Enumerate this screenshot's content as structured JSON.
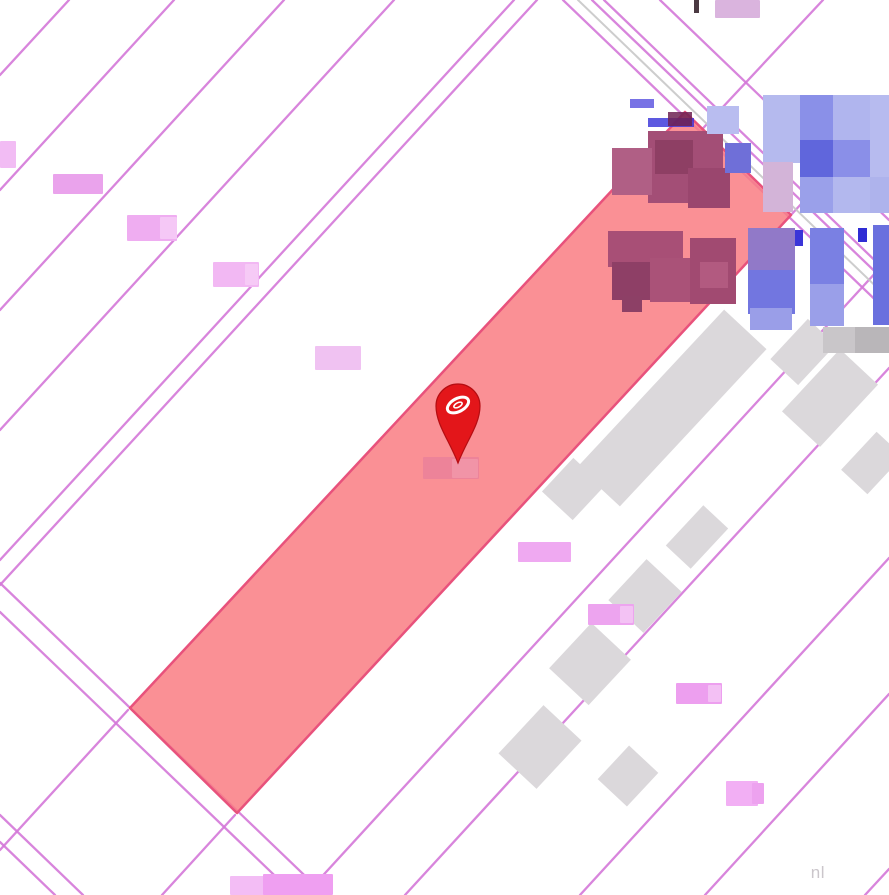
{
  "attribution": {
    "text": "nl"
  },
  "palette": {
    "background": "#ffffff",
    "parcel_line": "#d478d8",
    "road_gray_line": "#c8c8c8",
    "selected_fill": "#f97d82",
    "selected_stroke": "#e8527c",
    "building_gray": "#dbd8db",
    "pin_red": "#e3161a",
    "pin_rim": "#b50d12",
    "pin_logo": "#ffffff"
  },
  "map": {
    "width": 889,
    "height": 895,
    "lines": [
      {
        "x1": 0,
        "y1": 75,
        "x2": 69,
        "y2": 0
      },
      {
        "x1": 0,
        "y1": 190,
        "x2": 174,
        "y2": 0
      },
      {
        "x1": 0,
        "y1": 310,
        "x2": 284,
        "y2": 0
      },
      {
        "x1": 0,
        "y1": 430,
        "x2": 394,
        "y2": 0
      },
      {
        "x1": 0,
        "y1": 560,
        "x2": 514,
        "y2": 0
      },
      {
        "x1": 0,
        "y1": 585,
        "x2": 537,
        "y2": 0
      },
      {
        "x1": 0,
        "y1": 850,
        "x2": 128,
        "y2": 710
      },
      {
        "x1": 823,
        "y1": 0,
        "x2": 678,
        "y2": 155
      },
      {
        "x1": 162,
        "y1": 895,
        "x2": 235,
        "y2": 815
      },
      {
        "x1": 791,
        "y1": 215,
        "x2": 889,
        "y2": 108
      },
      {
        "x1": 305,
        "y1": 895,
        "x2": 889,
        "y2": 258
      },
      {
        "x1": 405,
        "y1": 895,
        "x2": 889,
        "y2": 368
      },
      {
        "x1": 580,
        "y1": 895,
        "x2": 889,
        "y2": 558
      },
      {
        "x1": 705,
        "y1": 895,
        "x2": 889,
        "y2": 694
      },
      {
        "x1": 865,
        "y1": 895,
        "x2": 889,
        "y2": 869
      },
      {
        "x1": 563,
        "y1": 0,
        "x2": 889,
        "y2": 313
      },
      {
        "x1": 578,
        "y1": 0,
        "x2": 889,
        "y2": 299,
        "c": "#c8c8c8",
        "w": 2
      },
      {
        "x1": 592,
        "y1": 0,
        "x2": 889,
        "y2": 285
      },
      {
        "x1": 604,
        "y1": 0,
        "x2": 889,
        "y2": 274
      },
      {
        "x1": 660,
        "y1": 0,
        "x2": 889,
        "y2": 220
      },
      {
        "x1": 0,
        "y1": 583,
        "x2": 325,
        "y2": 895
      },
      {
        "x1": 0,
        "y1": 612,
        "x2": 295,
        "y2": 895
      },
      {
        "x1": 0,
        "y1": 815,
        "x2": 83,
        "y2": 895
      },
      {
        "x1": 0,
        "y1": 842,
        "x2": 55,
        "y2": 895
      }
    ],
    "selected_parcel": {
      "points": "685,112 791,215 237,813 130,708",
      "fill": "#f97d82",
      "fill_opacity": 0.85,
      "stroke": "#e8527c",
      "stroke_width": 2.5
    },
    "gray_buildings": [
      {
        "cx": 672,
        "cy": 408,
        "w": 215,
        "h": 58,
        "a": -47
      },
      {
        "cx": 718,
        "cy": 350,
        "w": 60,
        "h": 40,
        "a": -47
      },
      {
        "cx": 573,
        "cy": 489,
        "w": 46,
        "h": 42,
        "a": -47
      },
      {
        "cx": 803,
        "cy": 352,
        "w": 55,
        "h": 38,
        "a": -47
      },
      {
        "cx": 830,
        "cy": 398,
        "w": 85,
        "h": 52,
        "a": -47
      },
      {
        "cx": 872,
        "cy": 463,
        "w": 52,
        "h": 36,
        "a": -47
      },
      {
        "cx": 697,
        "cy": 537,
        "w": 55,
        "h": 34,
        "a": -47
      },
      {
        "cx": 645,
        "cy": 596,
        "w": 56,
        "h": 48,
        "a": -47
      },
      {
        "cx": 590,
        "cy": 664,
        "w": 62,
        "h": 54,
        "a": -47
      },
      {
        "cx": 540,
        "cy": 747,
        "w": 66,
        "h": 52,
        "a": -47
      },
      {
        "cx": 628,
        "cy": 776,
        "w": 46,
        "h": 40,
        "a": -47
      }
    ],
    "pixel_blocks": [
      {
        "x": 648,
        "y": 131,
        "w": 75,
        "h": 72,
        "c": "#a34e76"
      },
      {
        "x": 655,
        "y": 140,
        "w": 38,
        "h": 34,
        "c": "#8e3f64"
      },
      {
        "x": 612,
        "y": 148,
        "w": 40,
        "h": 47,
        "c": "#b05f85"
      },
      {
        "x": 688,
        "y": 168,
        "w": 42,
        "h": 40,
        "c": "#9a466e"
      },
      {
        "x": 725,
        "y": 143,
        "w": 26,
        "h": 30,
        "c": "#6f6fd8"
      },
      {
        "x": 707,
        "y": 106,
        "w": 32,
        "h": 28,
        "c": "#b9bdf0"
      },
      {
        "x": 630,
        "y": 99,
        "w": 24,
        "h": 9,
        "c": "#4b43dc",
        "o": 0.75
      },
      {
        "x": 648,
        "y": 118,
        "w": 46,
        "h": 9,
        "c": "#342fd8",
        "o": 0.8
      },
      {
        "x": 668,
        "y": 112,
        "w": 24,
        "h": 14,
        "c": "#6d2152",
        "o": 0.85
      },
      {
        "x": 608,
        "y": 231,
        "w": 75,
        "h": 36,
        "c": "#a84f76"
      },
      {
        "x": 612,
        "y": 262,
        "w": 44,
        "h": 38,
        "c": "#8e3f66"
      },
      {
        "x": 650,
        "y": 258,
        "w": 52,
        "h": 44,
        "c": "#aa5278"
      },
      {
        "x": 690,
        "y": 238,
        "w": 46,
        "h": 66,
        "c": "#a14a71"
      },
      {
        "x": 622,
        "y": 296,
        "w": 20,
        "h": 16,
        "c": "#8d4066"
      },
      {
        "x": 700,
        "y": 262,
        "w": 28,
        "h": 26,
        "c": "#b25a80"
      },
      {
        "x": 763,
        "y": 95,
        "w": 48,
        "h": 68,
        "c": "#b5baee"
      },
      {
        "x": 800,
        "y": 95,
        "w": 34,
        "h": 46,
        "c": "#8a90e8"
      },
      {
        "x": 833,
        "y": 95,
        "w": 38,
        "h": 46,
        "c": "#b0b5ee"
      },
      {
        "x": 800,
        "y": 140,
        "w": 34,
        "h": 38,
        "c": "#6066dc"
      },
      {
        "x": 833,
        "y": 140,
        "w": 38,
        "h": 38,
        "c": "#8a8fe8"
      },
      {
        "x": 870,
        "y": 95,
        "w": 19,
        "h": 82,
        "c": "#b7bbef"
      },
      {
        "x": 763,
        "y": 162,
        "w": 30,
        "h": 50,
        "c": "#d3b4d8"
      },
      {
        "x": 800,
        "y": 177,
        "w": 34,
        "h": 36,
        "c": "#9aa0ea"
      },
      {
        "x": 833,
        "y": 177,
        "w": 38,
        "h": 36,
        "c": "#b3b8ee"
      },
      {
        "x": 870,
        "y": 177,
        "w": 19,
        "h": 36,
        "c": "#aeb3ec"
      },
      {
        "x": 748,
        "y": 228,
        "w": 47,
        "h": 44,
        "c": "#9179c8"
      },
      {
        "x": 748,
        "y": 270,
        "w": 47,
        "h": 44,
        "c": "#7276e0"
      },
      {
        "x": 750,
        "y": 308,
        "w": 42,
        "h": 22,
        "c": "#9a9ee8"
      },
      {
        "x": 810,
        "y": 228,
        "w": 34,
        "h": 58,
        "c": "#7a80e3"
      },
      {
        "x": 810,
        "y": 284,
        "w": 34,
        "h": 42,
        "c": "#9a9fe9"
      },
      {
        "x": 873,
        "y": 225,
        "w": 16,
        "h": 100,
        "c": "#6a70de"
      },
      {
        "x": 795,
        "y": 230,
        "w": 8,
        "h": 16,
        "c": "#3b35d8"
      },
      {
        "x": 858,
        "y": 228,
        "w": 9,
        "h": 14,
        "c": "#2f2cd4"
      },
      {
        "x": 823,
        "y": 327,
        "w": 34,
        "h": 26,
        "c": "#c9c6c9"
      },
      {
        "x": 855,
        "y": 327,
        "w": 34,
        "h": 26,
        "c": "#b9b6b9"
      },
      {
        "x": 694,
        "y": 0,
        "w": 5,
        "h": 13,
        "c": "#4b3a42"
      }
    ],
    "blurred_labels": [
      {
        "x": 0,
        "y": 141,
        "w": 16,
        "h": 27,
        "c": "#f2bcf4"
      },
      {
        "x": 53,
        "y": 174,
        "w": 50,
        "h": 20,
        "c": "#eaa3ec"
      },
      {
        "x": 127,
        "y": 215,
        "w": 50,
        "h": 26,
        "c": "#efadf1"
      },
      {
        "x": 160,
        "y": 217,
        "w": 17,
        "h": 22,
        "c": "#f5c8f6"
      },
      {
        "x": 213,
        "y": 262,
        "w": 46,
        "h": 25,
        "c": "#f2b8f3"
      },
      {
        "x": 245,
        "y": 264,
        "w": 13,
        "h": 21,
        "c": "#f6caf6"
      },
      {
        "x": 315,
        "y": 346,
        "w": 46,
        "h": 24,
        "c": "#f0c2f2"
      },
      {
        "x": 518,
        "y": 542,
        "w": 53,
        "h": 20,
        "c": "#efa9f1"
      },
      {
        "x": 588,
        "y": 604,
        "w": 46,
        "h": 21,
        "c": "#eda4ef"
      },
      {
        "x": 620,
        "y": 606,
        "w": 13,
        "h": 17,
        "c": "#f3c2f4"
      },
      {
        "x": 676,
        "y": 683,
        "w": 46,
        "h": 21,
        "c": "#ed9fef"
      },
      {
        "x": 708,
        "y": 685,
        "w": 13,
        "h": 17,
        "c": "#f3c0f4"
      },
      {
        "x": 230,
        "y": 876,
        "w": 60,
        "h": 19,
        "c": "#f3bdf5"
      },
      {
        "x": 263,
        "y": 874,
        "w": 70,
        "h": 21,
        "c": "#ef9ff1"
      },
      {
        "x": 715,
        "y": 0,
        "w": 45,
        "h": 18,
        "c": "#dab4de"
      },
      {
        "x": 726,
        "y": 781,
        "w": 32,
        "h": 25,
        "c": "#f2aff4"
      },
      {
        "x": 752,
        "y": 783,
        "w": 12,
        "h": 21,
        "c": "#eda2ef"
      },
      {
        "x": 423,
        "y": 457,
        "w": 56,
        "h": 22,
        "c": "#ed8399"
      },
      {
        "x": 452,
        "y": 459,
        "w": 26,
        "h": 19,
        "c": "#f194a7"
      }
    ],
    "marker": {
      "cx": 458,
      "cy": 406,
      "r": 22,
      "tip_y": 463,
      "body": "#e3161a",
      "rim": "#b50d12",
      "logo": "#ffffff"
    }
  }
}
